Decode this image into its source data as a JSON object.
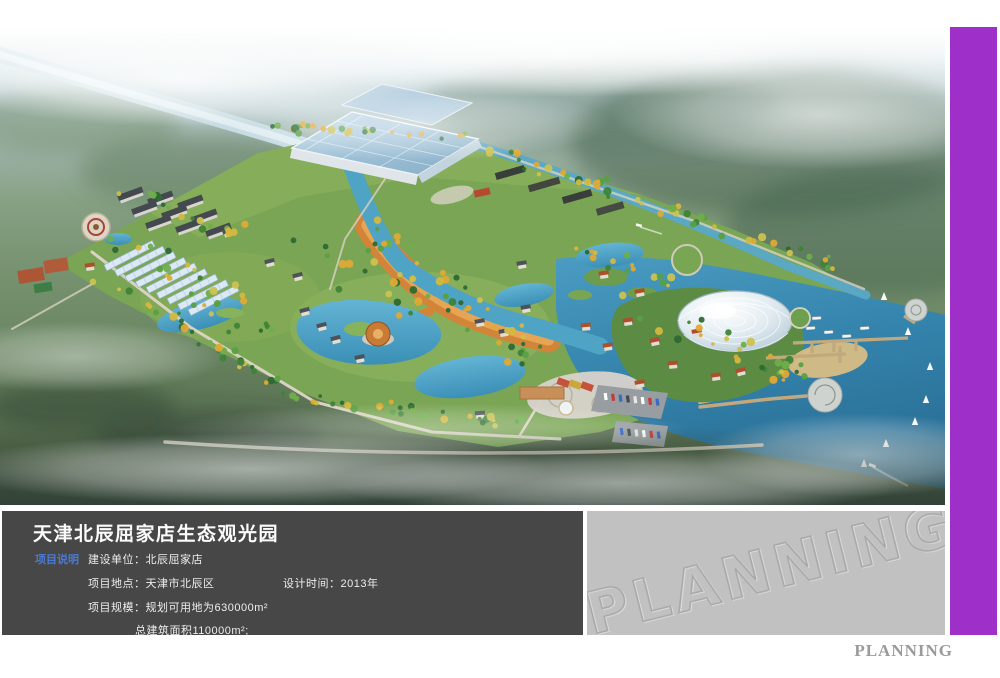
{
  "info_panel": {
    "title": "天津北辰屈家店生态观光园",
    "section_label": "项目说明",
    "construction_unit": "建设单位：北辰屈家店",
    "location": "项目地点：天津市北辰区",
    "design_time": "设计时间：2013年",
    "scale": "项目规模：规划可用地为630000m²",
    "floor_area": "总建筑面积110000m²;"
  },
  "watermark": {
    "text": "PLANNING"
  },
  "footer": {
    "logo": "PLANNING"
  },
  "colors": {
    "accent_purple": "#9e2fc9",
    "panel_dark": "#474747",
    "panel_gray": "#c2c1c1",
    "label_blue": "#4a79d2",
    "water_teal": "#3f94ba",
    "promenade_orange": "#d28438"
  }
}
